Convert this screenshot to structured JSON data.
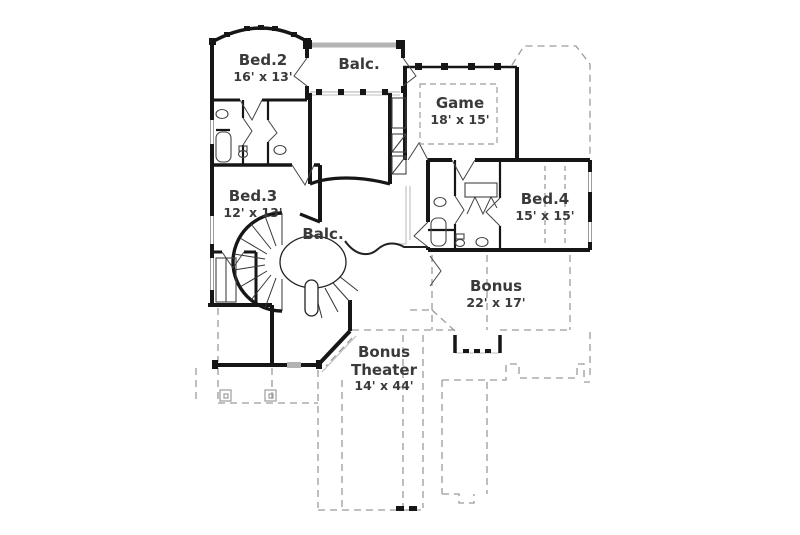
{
  "plan": {
    "rooms": [
      {
        "id": "bed2",
        "name": "Bed.2",
        "dims": "16' x 13'"
      },
      {
        "id": "balcony-top",
        "name": "Balc.",
        "dims": ""
      },
      {
        "id": "game",
        "name": "Game",
        "dims": "18' x 15'"
      },
      {
        "id": "bed3",
        "name": "Bed.3",
        "dims": "12' x 13'"
      },
      {
        "id": "bed4",
        "name": "Bed.4",
        "dims": "15' x 15'"
      },
      {
        "id": "balcony-center",
        "name": "Balc.",
        "dims": ""
      },
      {
        "id": "bonus",
        "name": "Bonus",
        "dims": "22' x 17'"
      },
      {
        "id": "bonus-theater",
        "name": "Bonus",
        "name2": "Theater",
        "dims": "14' x 44'"
      }
    ],
    "colors": {
      "wall": "#161616",
      "dashed_outline": "#9c9c9c",
      "light_line": "#bdbdbd",
      "railing": "#b3b3b3",
      "text": "#3a3a3a"
    }
  }
}
